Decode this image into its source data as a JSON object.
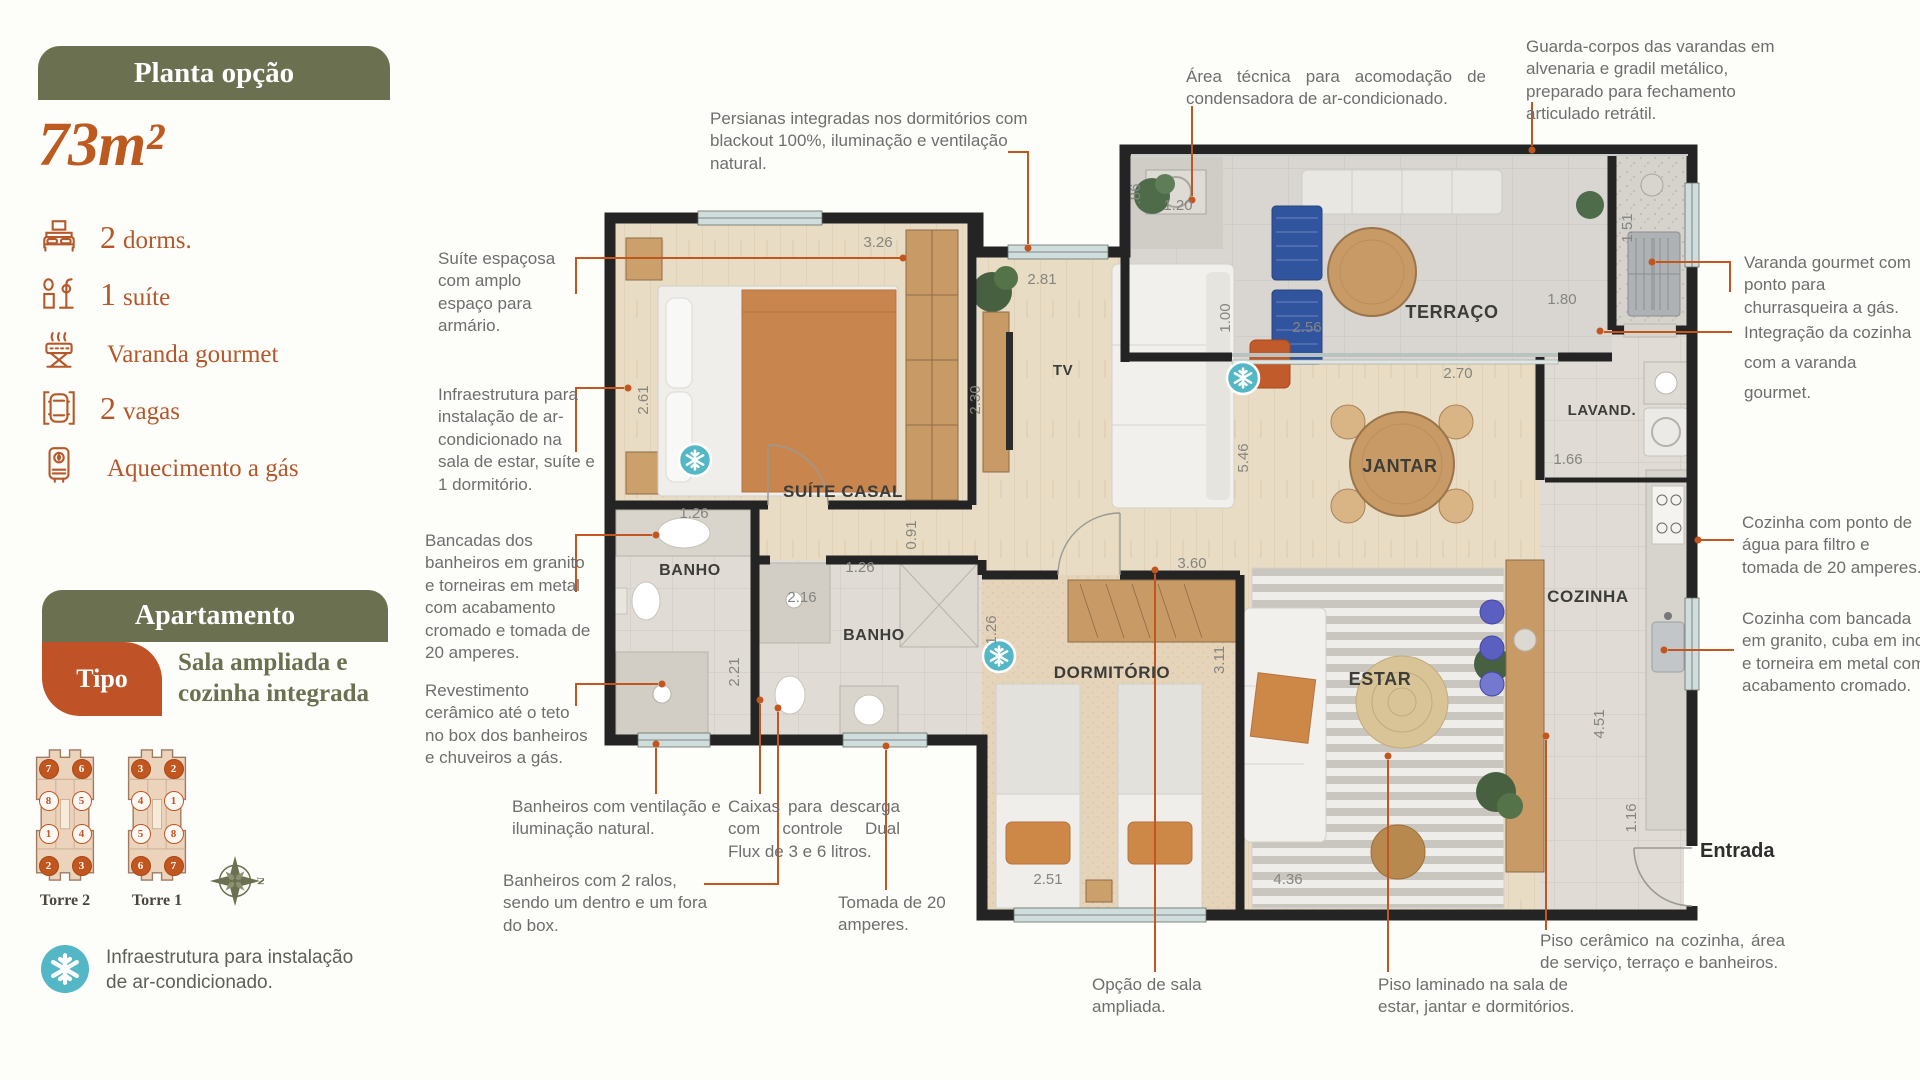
{
  "colors": {
    "olive": "#6b7150",
    "accent_orange": "#c2561f",
    "tipo_rust": "#bf5226",
    "snowflake_teal": "#53b7c6",
    "wall_dark": "#242424",
    "annotation_gray": "#6e6e6e"
  },
  "sidebar": {
    "plan_badge": "Planta opção",
    "area": "73m²",
    "amenities": [
      {
        "icon": "bed-icon",
        "qty": "2",
        "label": "dorms."
      },
      {
        "icon": "shower-icon",
        "qty": "1",
        "label": "suíte"
      },
      {
        "icon": "grill-icon",
        "qty": "",
        "label": "Varanda gourmet"
      },
      {
        "icon": "car-icon",
        "qty": "2",
        "label": "vagas"
      },
      {
        "icon": "heater-icon",
        "qty": "",
        "label": "Aquecimento a gás"
      }
    ],
    "apartment_header": "Apartamento",
    "tipo_label": "Tipo",
    "tipo_value": "Sala ampliada e cozinha integrada",
    "towers": [
      {
        "name": "Torre 2",
        "units": [
          {
            "n": "7",
            "filled": true
          },
          {
            "n": "6",
            "filled": true
          },
          {
            "n": "8",
            "filled": false
          },
          {
            "n": "5",
            "filled": false
          },
          {
            "n": "1",
            "filled": false
          },
          {
            "n": "4",
            "filled": false
          },
          {
            "n": "2",
            "filled": true
          },
          {
            "n": "3",
            "filled": true
          }
        ]
      },
      {
        "name": "Torre 1",
        "units": [
          {
            "n": "3",
            "filled": true
          },
          {
            "n": "2",
            "filled": true
          },
          {
            "n": "4",
            "filled": false
          },
          {
            "n": "1",
            "filled": false
          },
          {
            "n": "5",
            "filled": false
          },
          {
            "n": "8",
            "filled": false
          },
          {
            "n": "6",
            "filled": true
          },
          {
            "n": "7",
            "filled": true
          }
        ]
      }
    ],
    "compass_label": "N",
    "legend_icon": "snowflake-icon",
    "legend_text": "Infraestrutura para instalação de ar-condicionado."
  },
  "plan": {
    "rooms": [
      "SUÍTE CASAL",
      "BANHO",
      "BANHO",
      "TV",
      "TERRAÇO",
      "JANTAR",
      "LAVAND.",
      "COZINHA",
      "DORMITÓRIO",
      "ESTAR"
    ],
    "entrance_label": "Entrada",
    "dimensions": [
      "3.26",
      "2.61",
      "1.26",
      "2.21",
      "2.16",
      "1.26",
      "0.91",
      "2.81",
      "2.30",
      "1.00",
      ".86",
      "1.20",
      "2.56",
      "1.51",
      "1.80",
      "2.70",
      "1.66",
      "5.46",
      "3.60",
      "1.26",
      "3.11",
      "2.51",
      "4.36",
      "4.51",
      "1.16"
    ]
  },
  "annotations": [
    {
      "id": "persianas",
      "text": "Persianas integradas nos dormitórios com blackout 100%, iluminação e ventilação natural."
    },
    {
      "id": "area-tecnica",
      "text": "Área técnica para acomodação de condensadora de ar-condicionado."
    },
    {
      "id": "guarda-corpos",
      "text": "Guarda-corpos das varandas em alvenaria e gradil metálico, preparado para fechamento articulado retrátil."
    },
    {
      "id": "suite-espacosa",
      "text": "Suíte espaçosa com amplo espaço para armário."
    },
    {
      "id": "infra-ar-condicionado",
      "text": "Infraestrutura para instalação de ar-condicionado na sala de estar, suíte e 1 dormitório."
    },
    {
      "id": "bancadas-banheiros",
      "text": "Bancadas dos banheiros em granito e torneiras em metal com acabamento cromado e tomada de 20 amperes."
    },
    {
      "id": "revestimento-ceramico",
      "text": "Revestimento cerâmico até o teto no box dos banheiros e chuveiros a gás."
    },
    {
      "id": "banheiros-ventilacao",
      "text": "Banheiros com ventilação e iluminação natural."
    },
    {
      "id": "banheiros-ralos",
      "text": "Banheiros com 2 ralos, sendo um dentro e um fora do box."
    },
    {
      "id": "caixas-descarga",
      "text": "Caixas para descarga com controle Dual Flux de 3 e 6 litros."
    },
    {
      "id": "tomada",
      "text": "Tomada de 20 amperes."
    },
    {
      "id": "opcao-sala",
      "text": "Opção de sala ampliada."
    },
    {
      "id": "piso-laminado",
      "text": "Piso laminado na sala de estar, jantar e dormitórios."
    },
    {
      "id": "piso-ceramico",
      "text": "Piso cerâmico na cozinha, área de serviço, terraço e banheiros."
    },
    {
      "id": "varanda-churrasqueira",
      "text": "Varanda gourmet com ponto para churrasqueira a gás."
    },
    {
      "id": "integracao-cozinha",
      "text": "Integração da cozinha com a varanda gourmet."
    },
    {
      "id": "cozinha-ponto-agua",
      "text": "Cozinha com ponto de água para filtro e tomada de 20 amperes."
    },
    {
      "id": "cozinha-bancada",
      "text": "Cozinha com bancada em granito, cuba em inox e torneira em metal com acabamento cromado."
    }
  ]
}
